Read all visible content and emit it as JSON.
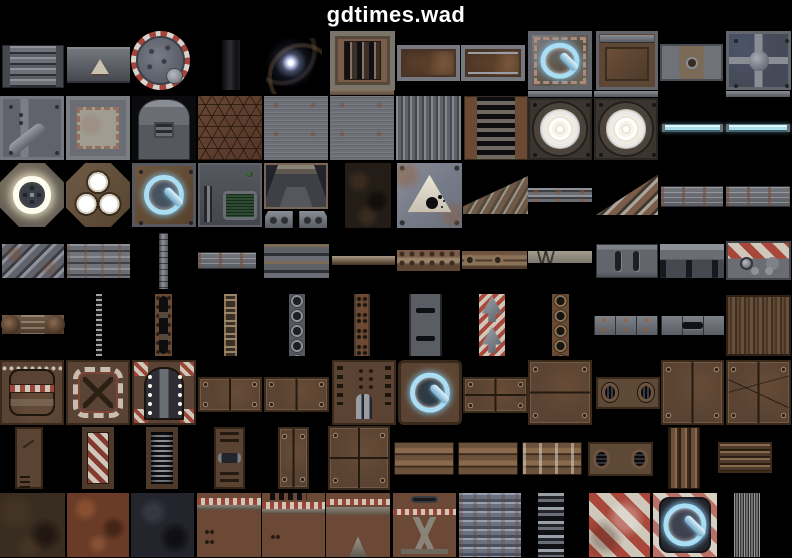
{
  "title": "gdtimes.wad",
  "palette": {
    "background": "#000000",
    "title_color": "#ffffff",
    "glow_blue": "#a9def5",
    "cyan_tube": "#a8e0ee",
    "hazard_red": "#a8473a",
    "hazard_cream": "#cfc7ba",
    "rust_brown": "#6b4a33",
    "panel_brown": "#5a4332",
    "metal_gray": "#6a6d74",
    "lamp_white": "#ffffff",
    "screen_green": "#2e4a30"
  },
  "tiles": [
    {
      "name": "metal-slats",
      "kind": "slats",
      "x": 2,
      "y": 45,
      "w": 62,
      "h": 43
    },
    {
      "name": "warning-plate-small",
      "kind": "graywall",
      "x": 67,
      "y": 47,
      "w": 63,
      "h": 36
    },
    {
      "name": "round-hatch",
      "kind": "hatch",
      "x": 131,
      "y": 31,
      "w": 59,
      "h": 59
    },
    {
      "name": "dark-column",
      "kind": "darkstrip",
      "x": 222,
      "y": 40,
      "w": 18,
      "h": 50
    },
    {
      "name": "light-flare",
      "kind": "flare",
      "x": 266,
      "y": 38,
      "w": 56,
      "h": 56
    },
    {
      "name": "rusty-grate",
      "kind": "grate",
      "x": 330,
      "y": 31,
      "w": 65,
      "h": 59
    },
    {
      "name": "rust-panel",
      "kind": "rustpanel",
      "x": 397,
      "y": 45,
      "w": 63,
      "h": 36
    },
    {
      "name": "rust-panel-lined",
      "kind": "rustpanel2",
      "x": 461,
      "y": 45,
      "w": 64,
      "h": 36
    },
    {
      "name": "power-plate-metal",
      "kind": "power-metal",
      "x": 528,
      "y": 31,
      "w": 64,
      "h": 59
    },
    {
      "name": "rust-frame-panel",
      "kind": "rustframe",
      "x": 596,
      "y": 31,
      "w": 62,
      "h": 59
    },
    {
      "name": "plate-with-dot",
      "kind": "dotplate",
      "x": 660,
      "y": 44,
      "w": 63,
      "h": 37
    },
    {
      "name": "cross-plate",
      "kind": "crossplate",
      "x": 726,
      "y": 31,
      "w": 65,
      "h": 59
    },
    {
      "name": "plate-diag-pipe",
      "kind": "pipeplate",
      "x": 0,
      "y": 96,
      "w": 64,
      "h": 64
    },
    {
      "name": "torn-plaster-plate",
      "kind": "plaster",
      "x": 66,
      "y": 96,
      "w": 64,
      "h": 64
    },
    {
      "name": "machine-face",
      "kind": "machine",
      "x": 132,
      "y": 96,
      "w": 64,
      "h": 64
    },
    {
      "name": "hex-brown",
      "kind": "hex",
      "x": 198,
      "y": 96,
      "w": 64,
      "h": 64
    },
    {
      "name": "brushed-metal",
      "kind": "brushed",
      "x": 264,
      "y": 96,
      "w": 64,
      "h": 64
    },
    {
      "name": "rust-sliver",
      "kind": "thinrust",
      "x": 330,
      "y": 89,
      "w": 64,
      "h": 6
    },
    {
      "name": "brushed-metal",
      "kind": "brushed",
      "x": 330,
      "y": 96,
      "w": 64,
      "h": 64
    },
    {
      "name": "corrugated-gray",
      "kind": "corrug",
      "x": 396,
      "y": 96,
      "w": 65,
      "h": 64
    },
    {
      "name": "ladder-grate",
      "kind": "ladder",
      "x": 464,
      "y": 96,
      "w": 64,
      "h": 64
    },
    {
      "name": "gray-sliver",
      "kind": "thingray",
      "x": 528,
      "y": 91,
      "w": 64,
      "h": 6
    },
    {
      "name": "floodlight",
      "kind": "lamp",
      "x": 528,
      "y": 98,
      "w": 64,
      "h": 62
    },
    {
      "name": "gray-sliver",
      "kind": "thingray",
      "x": 594,
      "y": 91,
      "w": 64,
      "h": 6
    },
    {
      "name": "floodlight",
      "kind": "lamp",
      "x": 594,
      "y": 98,
      "w": 64,
      "h": 62
    },
    {
      "name": "glow-tube",
      "kind": "cyanbar",
      "x": 662,
      "y": 124,
      "w": 61,
      "h": 8
    },
    {
      "name": "gray-sliver",
      "kind": "thingray",
      "x": 726,
      "y": 91,
      "w": 64,
      "h": 6
    },
    {
      "name": "glow-tube",
      "kind": "cyanbar",
      "x": 726,
      "y": 124,
      "w": 64,
      "h": 8
    },
    {
      "name": "octagon-light-ring",
      "kind": "octring",
      "x": 0,
      "y": 163,
      "w": 64,
      "h": 64
    },
    {
      "name": "octagon-three-lights",
      "kind": "octlights",
      "x": 66,
      "y": 163,
      "w": 64,
      "h": 64
    },
    {
      "name": "power-dial-round",
      "kind": "power-round",
      "x": 132,
      "y": 163,
      "w": 64,
      "h": 64
    },
    {
      "name": "tech-console",
      "kind": "console",
      "x": 198,
      "y": 163,
      "w": 64,
      "h": 64
    },
    {
      "name": "alcove-3d",
      "kind": "alcove",
      "x": 264,
      "y": 163,
      "w": 64,
      "h": 46
    },
    {
      "name": "alcove-brackets",
      "kind": "brackets",
      "x": 264,
      "y": 211,
      "w": 64,
      "h": 17
    },
    {
      "name": "dark-rock",
      "kind": "rock",
      "x": 345,
      "y": 163,
      "w": 46,
      "h": 65
    },
    {
      "name": "explosive-sign",
      "kind": "bombsign",
      "x": 397,
      "y": 163,
      "w": 65,
      "h": 65
    },
    {
      "name": "stairs-shallow",
      "kind": "stairs",
      "x": 463,
      "y": 176,
      "w": 65,
      "h": 38
    },
    {
      "name": "rail-bar",
      "kind": "railbar",
      "x": 528,
      "y": 188,
      "w": 64,
      "h": 14
    },
    {
      "name": "stairs-steep",
      "kind": "stairs2",
      "x": 596,
      "y": 172,
      "w": 62,
      "h": 43
    },
    {
      "name": "lined-bar",
      "kind": "linedbar",
      "x": 661,
      "y": 186,
      "w": 62,
      "h": 21
    },
    {
      "name": "lined-bar",
      "kind": "linedbar",
      "x": 726,
      "y": 186,
      "w": 64,
      "h": 21
    },
    {
      "name": "diagonal-girder",
      "kind": "diaggroove",
      "x": 2,
      "y": 244,
      "w": 62,
      "h": 34
    },
    {
      "name": "ridged-girder",
      "kind": "ridgebar",
      "x": 67,
      "y": 244,
      "w": 63,
      "h": 34
    },
    {
      "name": "support-post",
      "kind": "vpost",
      "x": 159,
      "y": 233,
      "w": 9,
      "h": 56
    },
    {
      "name": "small-lined-bar",
      "kind": "linedbar",
      "x": 198,
      "y": 252,
      "w": 58,
      "h": 17
    },
    {
      "name": "banded-girder",
      "kind": "bandbar",
      "x": 264,
      "y": 244,
      "w": 65,
      "h": 34
    },
    {
      "name": "thin-ledge",
      "kind": "ledge",
      "x": 332,
      "y": 256,
      "w": 63,
      "h": 9
    },
    {
      "name": "riveted-bar",
      "kind": "rivetbar",
      "x": 397,
      "y": 250,
      "w": 63,
      "h": 21
    },
    {
      "name": "pipe-fitting-bar",
      "kind": "pipebar",
      "x": 462,
      "y": 251,
      "w": 65,
      "h": 18
    },
    {
      "name": "notched-bar",
      "kind": "notchbar",
      "x": 528,
      "y": 251,
      "w": 64,
      "h": 12
    },
    {
      "name": "slotted-plate",
      "kind": "slotplate",
      "x": 596,
      "y": 244,
      "w": 62,
      "h": 34
    },
    {
      "name": "tabbed-plate",
      "kind": "tabplate",
      "x": 660,
      "y": 244,
      "w": 64,
      "h": 34
    },
    {
      "name": "hazard-machine",
      "kind": "hazmachine",
      "x": 726,
      "y": 241,
      "w": 65,
      "h": 39
    },
    {
      "name": "capped-bar",
      "kind": "capbar",
      "x": 2,
      "y": 315,
      "w": 62,
      "h": 19
    },
    {
      "name": "thin-chain",
      "kind": "chainthin",
      "x": 96,
      "y": 294,
      "w": 6,
      "h": 62
    },
    {
      "name": "vent-column",
      "kind": "ventcol",
      "x": 155,
      "y": 294,
      "w": 17,
      "h": 62
    },
    {
      "name": "chain-column",
      "kind": "chaincol",
      "x": 224,
      "y": 294,
      "w": 13,
      "h": 62
    },
    {
      "name": "port-column-gray",
      "kind": "portgray",
      "x": 289,
      "y": 294,
      "w": 16,
      "h": 62
    },
    {
      "name": "dot-column-rust",
      "kind": "dotcol",
      "x": 354,
      "y": 294,
      "w": 16,
      "h": 62
    },
    {
      "name": "slotted-column",
      "kind": "slotcol",
      "x": 409,
      "y": 294,
      "w": 33,
      "h": 62
    },
    {
      "name": "chevron-column",
      "kind": "chevcol",
      "x": 479,
      "y": 294,
      "w": 26,
      "h": 62
    },
    {
      "name": "port-column-rust",
      "kind": "portrust",
      "x": 552,
      "y": 294,
      "w": 17,
      "h": 62
    },
    {
      "name": "seamed-bar",
      "kind": "seambar",
      "x": 594,
      "y": 316,
      "w": 64,
      "h": 19
    },
    {
      "name": "slot-bar",
      "kind": "slotbar",
      "x": 661,
      "y": 316,
      "w": 63,
      "h": 19
    },
    {
      "name": "grain-panel",
      "kind": "wood",
      "x": 726,
      "y": 295,
      "w": 65,
      "h": 61
    },
    {
      "name": "hazard-door",
      "kind": "hazdoor",
      "x": 0,
      "y": 360,
      "w": 64,
      "h": 65
    },
    {
      "name": "hazard-ring-plate",
      "kind": "hazring",
      "x": 66,
      "y": 360,
      "w": 64,
      "h": 65
    },
    {
      "name": "arch-doorway",
      "kind": "archdoor",
      "x": 132,
      "y": 360,
      "w": 64,
      "h": 65
    },
    {
      "name": "panel-pair",
      "kind": "panels2",
      "x": 198,
      "y": 377,
      "w": 64,
      "h": 35
    },
    {
      "name": "panel-pair",
      "kind": "panels2",
      "x": 264,
      "y": 377,
      "w": 65,
      "h": 35
    },
    {
      "name": "vent-pipe-panel",
      "kind": "ventpanel",
      "x": 332,
      "y": 360,
      "w": 64,
      "h": 65
    },
    {
      "name": "power-plate-brown",
      "kind": "power-brown",
      "x": 398,
      "y": 360,
      "w": 64,
      "h": 65
    },
    {
      "name": "panel-quad-small",
      "kind": "panels4s",
      "x": 463,
      "y": 377,
      "w": 65,
      "h": 36
    },
    {
      "name": "split-panel",
      "kind": "splitpanel",
      "x": 528,
      "y": 360,
      "w": 64,
      "h": 65
    },
    {
      "name": "twin-hole-panel",
      "kind": "holepanel",
      "x": 596,
      "y": 377,
      "w": 64,
      "h": 32
    },
    {
      "name": "twin-door-panel",
      "kind": "panels2v",
      "x": 661,
      "y": 360,
      "w": 63,
      "h": 65
    },
    {
      "name": "scratched-door-panel",
      "kind": "panels2vx",
      "x": 726,
      "y": 360,
      "w": 65,
      "h": 65
    },
    {
      "name": "vented-pillar",
      "kind": "door-vent",
      "x": 15,
      "y": 427,
      "w": 28,
      "h": 62
    },
    {
      "name": "hazard-pillar",
      "kind": "door-haz",
      "x": 82,
      "y": 427,
      "w": 32,
      "h": 62
    },
    {
      "name": "grille-pillar",
      "kind": "door-grille",
      "x": 146,
      "y": 427,
      "w": 32,
      "h": 62
    },
    {
      "name": "clamp-pillar",
      "kind": "door-clamp",
      "x": 214,
      "y": 427,
      "w": 31,
      "h": 62
    },
    {
      "name": "narrow-door-pair",
      "kind": "panels2v",
      "x": 278,
      "y": 427,
      "w": 31,
      "h": 62
    },
    {
      "name": "door-quad",
      "kind": "panels4",
      "x": 328,
      "y": 426,
      "w": 62,
      "h": 64
    },
    {
      "name": "ridge-bar",
      "kind": "ridgewide",
      "x": 394,
      "y": 442,
      "w": 60,
      "h": 33
    },
    {
      "name": "ridge-bar",
      "kind": "ridgewide",
      "x": 458,
      "y": 442,
      "w": 60,
      "h": 33
    },
    {
      "name": "ridge-bar-streaked",
      "kind": "ridgestreak",
      "x": 522,
      "y": 442,
      "w": 60,
      "h": 33
    },
    {
      "name": "oval-hole-bar",
      "kind": "holebar",
      "x": 588,
      "y": 442,
      "w": 65,
      "h": 34
    },
    {
      "name": "triple-rib-pillar",
      "kind": "ribs3",
      "x": 668,
      "y": 427,
      "w": 32,
      "h": 62
    },
    {
      "name": "ribbed-block",
      "kind": "ribblock",
      "x": 718,
      "y": 442,
      "w": 54,
      "h": 31
    },
    {
      "name": "dark-dirt",
      "kind": "dirt",
      "x": 0,
      "y": 493,
      "w": 65,
      "h": 64
    },
    {
      "name": "red-rust",
      "kind": "redrust",
      "x": 67,
      "y": 493,
      "w": 62,
      "h": 64
    },
    {
      "name": "dark-slate",
      "kind": "slate",
      "x": 131,
      "y": 493,
      "w": 63,
      "h": 64
    },
    {
      "name": "ledge-wall",
      "kind": "wall-ledge",
      "x": 197,
      "y": 493,
      "w": 64,
      "h": 64
    },
    {
      "name": "vented-wall",
      "kind": "wall-vent",
      "x": 262,
      "y": 493,
      "w": 63,
      "h": 64
    },
    {
      "name": "bracket-wall",
      "kind": "wall-bracket",
      "x": 326,
      "y": 493,
      "w": 64,
      "h": 64
    },
    {
      "name": "strut-wall",
      "kind": "wall-strut",
      "x": 393,
      "y": 493,
      "w": 63,
      "h": 64
    },
    {
      "name": "corrugated-blue",
      "kind": "bluecorrug",
      "x": 459,
      "y": 493,
      "w": 62,
      "h": 64
    },
    {
      "name": "banded-column",
      "kind": "bandcol",
      "x": 538,
      "y": 493,
      "w": 26,
      "h": 64
    },
    {
      "name": "hazard-stripes",
      "kind": "hazdiag",
      "x": 589,
      "y": 493,
      "w": 61,
      "h": 64
    },
    {
      "name": "power-speaker",
      "kind": "power-hazard",
      "x": 653,
      "y": 493,
      "w": 64,
      "h": 64
    },
    {
      "name": "wire-strands",
      "kind": "fibers",
      "x": 734,
      "y": 493,
      "w": 26,
      "h": 64
    }
  ]
}
